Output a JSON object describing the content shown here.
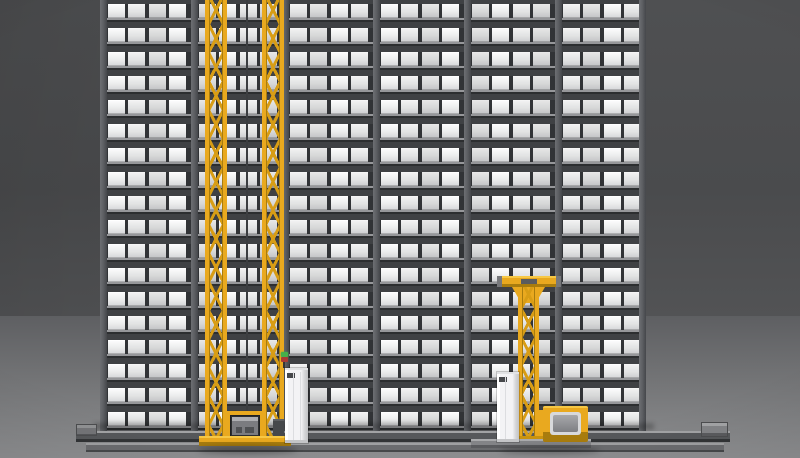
{
  "scene": {
    "kind": "3d-render",
    "subject": "Automated storage and retrieval system (AS/RS): high-bay tote rack with two yellow stacker cranes on floor rails",
    "rack": {
      "rows": 18,
      "bays": 6,
      "boxes_per_bay": 4,
      "row_pitch_px": 24,
      "bay_pitch_px": 91,
      "post_width_px": 7
    },
    "equipment": {
      "twin_mast_crane": {
        "masts": 2,
        "carries": "gray tote in load carriage",
        "status_lamps": [
          "green",
          "red"
        ]
      },
      "single_mast_crane": {
        "masts": 1,
        "top": "T-shaped guide beam",
        "carries": "gray tote in load carriage"
      },
      "control_cabinets": 2,
      "floor_rails": 2,
      "rail_end_stops": 2
    },
    "colors": {
      "rack_frame": "#3f4144",
      "rack_recess": "#313336",
      "shelf_highlight": "#96979a",
      "rack_shadow": "#2c2e30",
      "post": "#5e6064",
      "crane_yellow": "#e9a91f",
      "crane_yellow_light": "#f7c845",
      "crane_yellow_dark": "#a87c0e",
      "lattice": "#d89d15",
      "tote_top": "#aeafb2",
      "tote_body": "#7b7c80",
      "tote_dark": "#4f5154",
      "cabinet": "#f3f3f5",
      "cabinet_shade": "#d5d6d8",
      "cabinet_vent": "#46484b",
      "rail_top": "#a2a3a5",
      "rail_body": "#56585b",
      "rail_front": "#6b6c6f",
      "rail_dark": "#323436",
      "base_gray": "#838487",
      "light_green": "#45b04a",
      "light_red": "#aa3b33",
      "wall": "#4b4c4e",
      "floor_bottom": "#8e8f91"
    }
  }
}
